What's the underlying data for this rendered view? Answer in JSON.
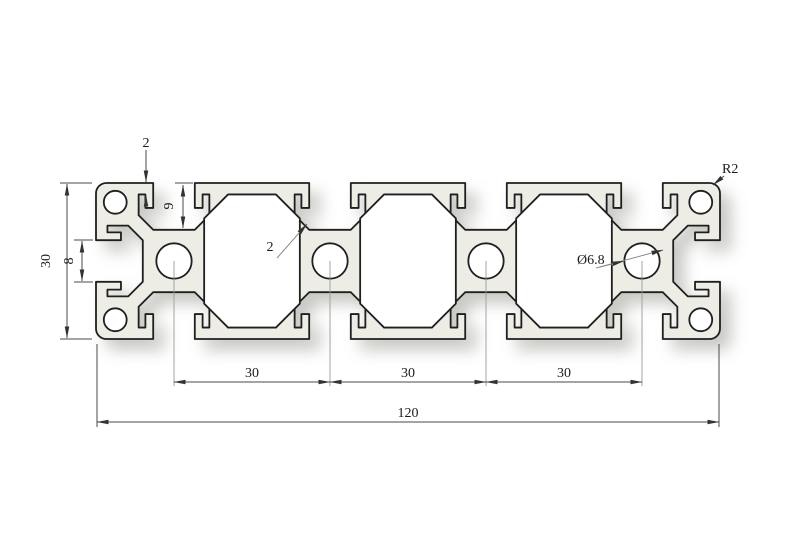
{
  "drawing": {
    "title": "aluminium-extrusion-profile-30x120-cross-section",
    "colors": {
      "background": "#ffffff",
      "profile_fill": "#EDEDE6",
      "outline": "#1f1f1f",
      "dimension_lines": "#4a4a4a"
    },
    "labels": {
      "flange_thickness": "2",
      "slot_depth": "9",
      "web_thickness": "2",
      "center_hole_diameter": "Ø6.8",
      "corner_radius": "R2",
      "overall_height": "30",
      "slot_opening": "8",
      "pitch_1": "30",
      "pitch_2": "30",
      "pitch_3": "30",
      "overall_width": "120"
    }
  }
}
